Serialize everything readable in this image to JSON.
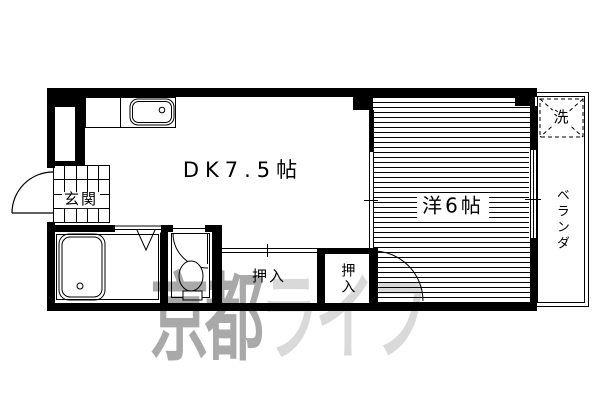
{
  "floorplan": {
    "rooms": {
      "dk": {
        "label": "DK7.5帖"
      },
      "western": {
        "label": "洋6帖"
      },
      "genkan": {
        "label": "玄関"
      },
      "closet1": {
        "label": "押入"
      },
      "closet2": {
        "label": "押入"
      },
      "veranda": {
        "label": "ベランダ"
      },
      "washer": {
        "label": "洗"
      }
    },
    "watermark": {
      "part1": "京都",
      "part2": "ライフ",
      "color1": "#a9a9a9",
      "color2": "#d9d9d9"
    },
    "colors": {
      "wall": "#000000",
      "background": "#ffffff",
      "line": "#000000"
    }
  }
}
